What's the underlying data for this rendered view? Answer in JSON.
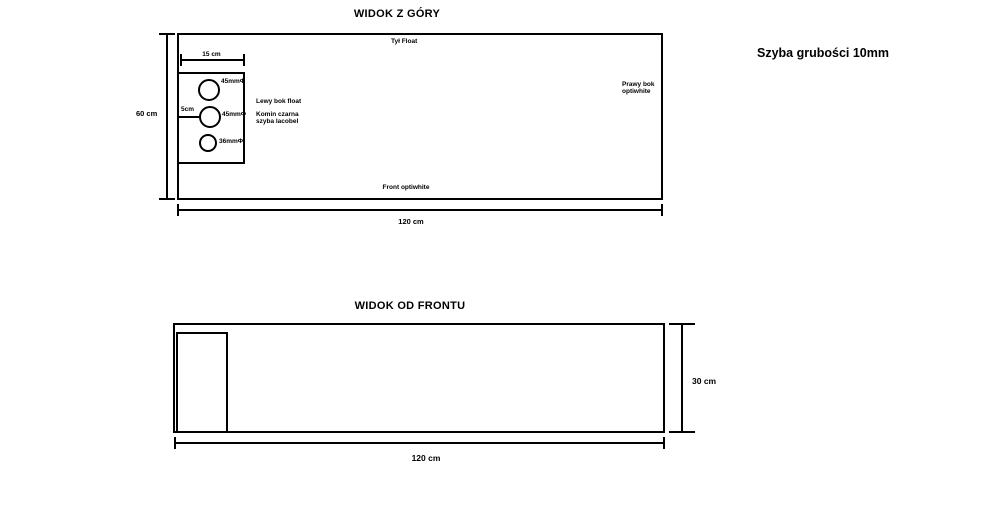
{
  "note": {
    "glass_thickness": "Szyba grubości 10mm"
  },
  "top_view": {
    "title": "WIDOK Z GÓRY",
    "labels": {
      "back_panel": "Tył Float",
      "front_panel": "Front optiwhite",
      "right_panel_line1": "Prawy bok",
      "right_panel_line2": "optiwhite",
      "left_panel": "Lewy bok float",
      "chimney_line1": "Komin czarna",
      "chimney_line2": "szyba lacobel"
    },
    "dimensions": {
      "width": "120 cm",
      "depth": "60 cm",
      "chimney_width": "15 cm",
      "hole_offset": "5cm"
    },
    "holes": [
      {
        "label": "45mmΦ"
      },
      {
        "label": "45mmΦ"
      },
      {
        "label": "36mmΦ"
      }
    ]
  },
  "front_view": {
    "title": "WIDOK OD FRONTU",
    "dimensions": {
      "width": "120 cm",
      "height": "30 cm"
    }
  }
}
